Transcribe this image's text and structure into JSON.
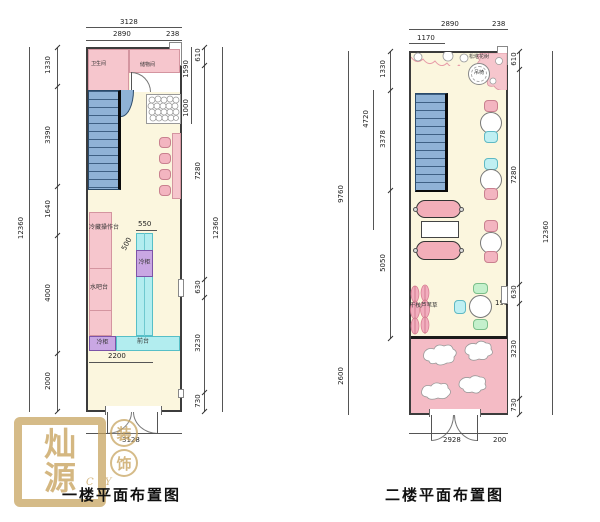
{
  "titles": {
    "floor1": "一楼平面布置图",
    "floor2": "二楼平面布置图"
  },
  "floor1": {
    "rooms": {
      "bathroom": "卫生间",
      "storage": "储物间"
    },
    "labels": {
      "cold_prep": "冷藏操作台",
      "water_bar": "水吧台",
      "freezer_top": "冷柜",
      "freezer_bottom": "冷柜",
      "front_desk": "前台"
    },
    "dims": {
      "top": [
        "3128",
        "2890",
        "238"
      ],
      "left": [
        "1330",
        "3390",
        "1640",
        "4000",
        "2000"
      ],
      "left_total": "12360",
      "right_inner": [
        "1590",
        "1000"
      ],
      "right": [
        "610",
        "7280",
        "630",
        "3230",
        "730"
      ],
      "right_total": "12360",
      "inner": [
        "550",
        "500",
        "2200"
      ],
      "bottom": "3128"
    }
  },
  "floor2": {
    "labels": {
      "flower_tree": "松塔花树",
      "hanging_chair": "吊椅",
      "dry_branch": "干枝芦苇草"
    },
    "dims": {
      "top": [
        "2890",
        "238",
        "1170"
      ],
      "left": [
        "1330",
        "3378",
        "5050"
      ],
      "left_mid": "4720",
      "left_outer": [
        "9760",
        "2600"
      ],
      "right": [
        "610",
        "7280",
        "630",
        "3230",
        "730"
      ],
      "right_total": "12360",
      "inner": "195",
      "bottom": [
        "2928",
        "200"
      ]
    }
  },
  "watermark": {
    "seal": [
      "灿",
      "源"
    ],
    "badges": [
      "装",
      "饰"
    ],
    "letters": "C Y"
  },
  "colors": {
    "floor": "#FBF6DE",
    "pink": "#F6C6CD",
    "cyan": "#B2EDEF",
    "purple": "#C9A7E3",
    "stair_blue": "#8FB2D6",
    "gold": "#C6A15B"
  }
}
